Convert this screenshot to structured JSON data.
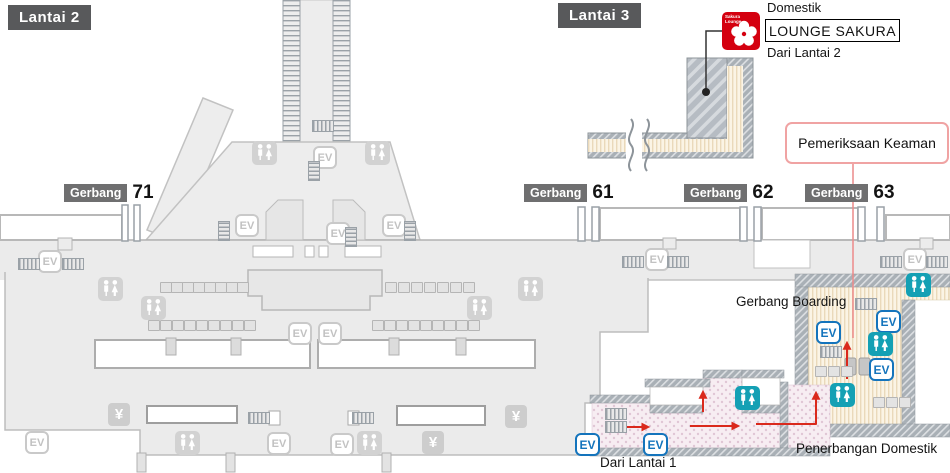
{
  "floors": {
    "lantai2": "Lantai 2",
    "lantai3": "Lantai 3"
  },
  "lounge": {
    "domestik": "Domestik",
    "name": "LOUNGE SAKURA",
    "from": "Dari Lantai 2",
    "icon_line1": "Sakura",
    "icon_line2": "Lounge"
  },
  "security": {
    "label": "Pemeriksaan Keaman"
  },
  "notes": {
    "boarding": "Gerbang Boarding",
    "domestic": "Penerbangan Domestik",
    "from_l1": "Dari Lantai 1"
  },
  "map": {
    "icon_labels": {
      "ev": "EV",
      "yen": "¥"
    },
    "gates": [
      {
        "badge": "Gerbang",
        "number": "71",
        "x": 64,
        "y": 182
      },
      {
        "badge": "Gerbang",
        "number": "61",
        "x": 524,
        "y": 182
      },
      {
        "badge": "Gerbang",
        "number": "62",
        "x": 684,
        "y": 182
      },
      {
        "badge": "Gerbang",
        "number": "63",
        "x": 805,
        "y": 182
      }
    ],
    "icons": [
      {
        "t": "ev-gray",
        "x": 38,
        "y": 250
      },
      {
        "t": "ev-gray",
        "x": 235,
        "y": 214
      },
      {
        "t": "ev-gray",
        "x": 313,
        "y": 146
      },
      {
        "t": "ev-gray",
        "x": 326,
        "y": 222
      },
      {
        "t": "ev-gray",
        "x": 382,
        "y": 214
      },
      {
        "t": "ev-gray",
        "x": 288,
        "y": 322
      },
      {
        "t": "ev-gray",
        "x": 318,
        "y": 322
      },
      {
        "t": "ev-gray",
        "x": 645,
        "y": 248
      },
      {
        "t": "ev-gray",
        "x": 903,
        "y": 248
      },
      {
        "t": "ev-gray",
        "x": 25,
        "y": 431
      },
      {
        "t": "ev-gray",
        "x": 267,
        "y": 432
      },
      {
        "t": "ev-gray",
        "x": 330,
        "y": 433
      },
      {
        "t": "ev-blue",
        "x": 575,
        "y": 433
      },
      {
        "t": "ev-blue",
        "x": 643,
        "y": 433
      },
      {
        "t": "ev-blue",
        "x": 816,
        "y": 321
      },
      {
        "t": "ev-blue",
        "x": 876,
        "y": 310
      },
      {
        "t": "ev-blue",
        "x": 869,
        "y": 358
      },
      {
        "t": "wc-gray",
        "x": 98,
        "y": 277
      },
      {
        "t": "wc-gray",
        "x": 141,
        "y": 296
      },
      {
        "t": "wc-gray",
        "x": 252,
        "y": 141
      },
      {
        "t": "wc-gray",
        "x": 365,
        "y": 141
      },
      {
        "t": "wc-gray",
        "x": 467,
        "y": 296
      },
      {
        "t": "wc-gray",
        "x": 518,
        "y": 277
      },
      {
        "t": "wc-gray",
        "x": 175,
        "y": 431
      },
      {
        "t": "wc-gray",
        "x": 357,
        "y": 431
      },
      {
        "t": "wc-teal",
        "x": 906,
        "y": 273
      },
      {
        "t": "wc-teal",
        "x": 868,
        "y": 332
      },
      {
        "t": "wc-teal",
        "x": 830,
        "y": 383
      },
      {
        "t": "wc-teal",
        "x": 735,
        "y": 386
      },
      {
        "t": "yen",
        "x": 108,
        "y": 403
      },
      {
        "t": "yen",
        "x": 505,
        "y": 405
      },
      {
        "t": "yen",
        "x": 422,
        "y": 431
      },
      {
        "t": "esc-h",
        "x": 18,
        "y": 258
      },
      {
        "t": "esc-h",
        "x": 62,
        "y": 258
      },
      {
        "t": "esc-h",
        "x": 622,
        "y": 256
      },
      {
        "t": "esc-h",
        "x": 667,
        "y": 256
      },
      {
        "t": "esc-h",
        "x": 880,
        "y": 256
      },
      {
        "t": "esc-h",
        "x": 926,
        "y": 256
      },
      {
        "t": "esc-h",
        "x": 312,
        "y": 120
      },
      {
        "t": "esc-h",
        "x": 248,
        "y": 412
      },
      {
        "t": "esc-h",
        "x": 352,
        "y": 412
      },
      {
        "t": "esc-h",
        "x": 605,
        "y": 408
      },
      {
        "t": "esc-h",
        "x": 605,
        "y": 421
      },
      {
        "t": "esc-h",
        "x": 855,
        "y": 298
      },
      {
        "t": "esc-h",
        "x": 820,
        "y": 346
      },
      {
        "t": "esc-v",
        "x": 218,
        "y": 221
      },
      {
        "t": "esc-v",
        "x": 404,
        "y": 221
      },
      {
        "t": "esc-v",
        "x": 308,
        "y": 161
      },
      {
        "t": "esc-v",
        "x": 345,
        "y": 227
      }
    ],
    "seat_rows": [
      {
        "x": 160,
        "y": 282,
        "n": 8,
        "p": 11
      },
      {
        "x": 148,
        "y": 320,
        "n": 9,
        "p": 12
      },
      {
        "x": 385,
        "y": 282,
        "n": 7,
        "p": 13
      },
      {
        "x": 372,
        "y": 320,
        "n": 9,
        "p": 12
      },
      {
        "x": 815,
        "y": 366,
        "n": 3,
        "p": 13
      },
      {
        "x": 873,
        "y": 397,
        "n": 3,
        "p": 13
      }
    ]
  },
  "colors": {
    "terminal_gray": "#ebebeb",
    "badge_dark": "#58595b",
    "badge_gate": "#6f6f70",
    "lounge_red": "#d4000f",
    "route_red": "#da291c",
    "security_border": "#f0a3a3",
    "ev_blue": "#1474bc",
    "restroom_teal": "#14a0b4",
    "corridor_cream": "#fbf4e5",
    "corridor_pink": "#f7edf2"
  }
}
